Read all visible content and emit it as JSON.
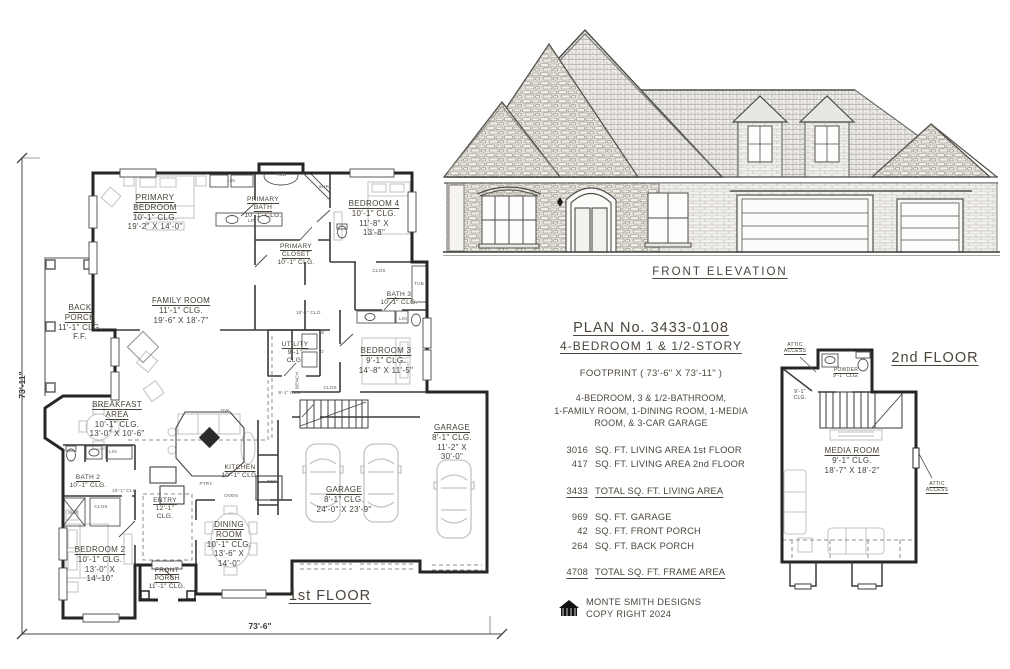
{
  "titles": {
    "front_elevation": "FRONT ELEVATION",
    "first_floor": "1st FLOOR",
    "second_floor": "2nd FLOOR"
  },
  "dimensions": {
    "overall_depth": "73'-11\"",
    "overall_width": "73'-6\""
  },
  "info": {
    "plan_no": "PLAN No. 3433-0108",
    "subtitle": "4-BEDROOM  1 & 1/2-STORY",
    "footprint": "FOOTPRINT ( 73'-6\" X 73'-11\" )",
    "description": [
      "4-BEDROOM, 3 & 1/2-BATHROOM,",
      "1-FAMILY ROOM, 1-DINING ROOM, 1-MEDIA",
      "ROOM, & 3-CAR GARAGE"
    ],
    "areas": [
      {
        "value": "3016",
        "label": "SQ. FT. LIVING AREA 1st FLOOR"
      },
      {
        "value": "417",
        "label": "SQ. FT. LIVING AREA 2nd FLOOR"
      }
    ],
    "total_living": {
      "value": "3433",
      "label": "TOTAL SQ. FT. LIVING AREA"
    },
    "other_areas": [
      {
        "value": "969",
        "label": "SQ. FT. GARAGE"
      },
      {
        "value": "42",
        "label": "SQ. FT. FRONT PORCH"
      },
      {
        "value": "264",
        "label": "SQ. FT. BACK PORCH"
      }
    ],
    "total_frame": {
      "value": "4708",
      "label": "TOTAL SQ. FT. FRAME AREA"
    },
    "credit_line1": "MONTE SMITH DESIGNS",
    "credit_line2": "COPY RIGHT 2024"
  },
  "floor1_rooms": [
    {
      "id": "primary-bedroom",
      "x": 155,
      "y": 193,
      "size": "m",
      "lines": [
        {
          "t": "PRIMARY",
          "u": 1
        },
        {
          "t": "BEDROOM",
          "u": 1
        },
        {
          "t": "10'-1\" CLG."
        },
        {
          "t": "19'-2\" X 14'-0\""
        }
      ]
    },
    {
      "id": "primary-bath",
      "x": 263,
      "y": 196,
      "size": "s",
      "lines": [
        {
          "t": "PRIMARY",
          "u": 1
        },
        {
          "t": "BATH",
          "u": 1
        },
        {
          "t": "10'-1\" CLG."
        }
      ]
    },
    {
      "id": "bedroom-4",
      "x": 374,
      "y": 199,
      "size": "m",
      "lines": [
        {
          "t": "BEDROOM 4",
          "u": 1
        },
        {
          "t": "10'-1\" CLG."
        },
        {
          "t": "11'-8\" X"
        },
        {
          "t": "13'-8\""
        }
      ]
    },
    {
      "id": "primary-closet",
      "x": 296,
      "y": 243,
      "size": "s",
      "lines": [
        {
          "t": "PRIMARY",
          "u": 1
        },
        {
          "t": "CLOSET",
          "u": 1
        },
        {
          "t": "10'-1\" CLG."
        }
      ]
    },
    {
      "id": "bath-3",
      "x": 399,
      "y": 291,
      "size": "s",
      "lines": [
        {
          "t": "BATH 3",
          "u": 1
        },
        {
          "t": "10'-1\" CLG."
        }
      ]
    },
    {
      "id": "back-porch",
      "x": 80,
      "y": 303,
      "size": "m",
      "lines": [
        {
          "t": "BACK",
          "u": 1
        },
        {
          "t": "PORCH",
          "u": 1
        },
        {
          "t": "11'-1\" CLG."
        },
        {
          "t": "F.F."
        }
      ]
    },
    {
      "id": "family-room",
      "x": 181,
      "y": 296,
      "size": "m",
      "lines": [
        {
          "t": "FAMILY ROOM",
          "u": 1
        },
        {
          "t": "11'-1\" CLG."
        },
        {
          "t": "19'-6\" X 18'-7\""
        }
      ]
    },
    {
      "id": "utility",
      "x": 295,
      "y": 341,
      "size": "s",
      "lines": [
        {
          "t": "UTILITY",
          "u": 1
        },
        {
          "t": "9'-1\""
        },
        {
          "t": "CLG."
        }
      ]
    },
    {
      "id": "bedroom-3",
      "x": 386,
      "y": 346,
      "size": "m",
      "lines": [
        {
          "t": "BEDROOM 3",
          "u": 1
        },
        {
          "t": "9'-1\" CLG."
        },
        {
          "t": "14'-8\" X 11'-5\""
        }
      ]
    },
    {
      "id": "breakfast-area",
      "x": 117,
      "y": 400,
      "size": "m",
      "lines": [
        {
          "t": "BREAKFAST",
          "u": 1
        },
        {
          "t": "AREA",
          "u": 1
        },
        {
          "t": "10'-1\" CLG."
        },
        {
          "t": "13'-0\" X 10'-6\""
        }
      ]
    },
    {
      "id": "kitchen",
      "x": 240,
      "y": 464,
      "size": "s",
      "lines": [
        {
          "t": "KITCHEN",
          "u": 1
        },
        {
          "t": "10'-1\" CLG."
        }
      ]
    },
    {
      "id": "bath-2",
      "x": 88,
      "y": 474,
      "size": "s",
      "lines": [
        {
          "t": "BATH 2",
          "u": 1
        },
        {
          "t": "10'-1\" CLG."
        }
      ]
    },
    {
      "id": "entry",
      "x": 165,
      "y": 497,
      "size": "s",
      "lines": [
        {
          "t": "ENTRY",
          "u": 1
        },
        {
          "t": "12'-1\""
        },
        {
          "t": "CLG."
        }
      ]
    },
    {
      "id": "dining-room",
      "x": 229,
      "y": 520,
      "size": "m",
      "lines": [
        {
          "t": "DINING",
          "u": 1
        },
        {
          "t": "ROOM",
          "u": 1
        },
        {
          "t": "10'-1\" CLG."
        },
        {
          "t": "13'-6\" X"
        },
        {
          "t": "14'-0\""
        }
      ]
    },
    {
      "id": "bedroom-2",
      "x": 100,
      "y": 545,
      "size": "m",
      "lines": [
        {
          "t": "BEDROOM 2",
          "u": 1
        },
        {
          "t": "10'-1\" CLG."
        },
        {
          "t": "13'-0\" X"
        },
        {
          "t": "14'-10\""
        }
      ]
    },
    {
      "id": "front-porch",
      "x": 167,
      "y": 567,
      "size": "s",
      "lines": [
        {
          "t": "FRONT",
          "u": 1
        },
        {
          "t": "PORCH",
          "u": 1
        },
        {
          "t": "11'-1\" CLG."
        }
      ]
    },
    {
      "id": "garage-main",
      "x": 344,
      "y": 485,
      "size": "m",
      "lines": [
        {
          "t": "GARAGE",
          "u": 1
        },
        {
          "t": "8'-1\" CLG."
        },
        {
          "t": "24'-0\" X 23'-9\""
        }
      ]
    },
    {
      "id": "garage-single",
      "x": 452,
      "y": 423,
      "size": "m",
      "lines": [
        {
          "t": "GARAGE",
          "u": 1
        },
        {
          "t": "8'-1\" CLG."
        },
        {
          "t": "11'-2\" X"
        },
        {
          "t": "30'-0\""
        }
      ]
    }
  ],
  "floor2_rooms": [
    {
      "id": "media-room",
      "x": 852,
      "y": 446,
      "size": "m",
      "lines": [
        {
          "t": "MEDIA ROOM",
          "u": 1
        },
        {
          "t": "9'-1\" CLG."
        },
        {
          "t": "18'-7\" X 18'-2\""
        }
      ]
    },
    {
      "id": "powder",
      "x": 846,
      "y": 368,
      "size": "t",
      "lines": [
        {
          "t": "POWDER",
          "u": 1
        },
        {
          "t": "9'-1\" CLG."
        }
      ]
    },
    {
      "id": "attic-access-left",
      "x": 795,
      "y": 343,
      "size": "t",
      "lines": [
        {
          "t": "ATTIC",
          "u": 1
        },
        {
          "t": "ACCESS",
          "u": 1
        }
      ]
    },
    {
      "id": "attic-access-right",
      "x": 937,
      "y": 482,
      "size": "t",
      "lines": [
        {
          "t": "ATTIC",
          "u": 1
        },
        {
          "t": "ACCESS",
          "u": 1
        }
      ]
    },
    {
      "id": "ceiling-note-2f",
      "x": 800,
      "y": 390,
      "size": "t",
      "lines": [
        {
          "t": "9'-1\""
        },
        {
          "t": "CLG."
        }
      ]
    }
  ],
  "small_labels": [
    {
      "x": 281,
      "y": 172,
      "t": "TUB"
    },
    {
      "x": 324,
      "y": 184,
      "t": "SHR"
    },
    {
      "x": 231,
      "y": 178,
      "t": "LIN"
    },
    {
      "x": 252,
      "y": 218,
      "t": "LIN"
    },
    {
      "x": 379,
      "y": 268,
      "t": "CLOS"
    },
    {
      "x": 419,
      "y": 281,
      "t": "TUB"
    },
    {
      "x": 403,
      "y": 316,
      "t": "LIN"
    },
    {
      "x": 322,
      "y": 330,
      "t": "W"
    },
    {
      "x": 322,
      "y": 349,
      "t": "D"
    },
    {
      "x": 297,
      "y": 378,
      "t": "BENCH",
      "rot": 1
    },
    {
      "x": 330,
      "y": 385,
      "t": "CLOS"
    },
    {
      "x": 225,
      "y": 408,
      "t": "DW"
    },
    {
      "x": 206,
      "y": 481,
      "t": "PTRY"
    },
    {
      "x": 231,
      "y": 493,
      "t": "OVEN"
    },
    {
      "x": 272,
      "y": 479,
      "t": "REF"
    },
    {
      "x": 309,
      "y": 310,
      "t": "10'-1\" CLG."
    },
    {
      "x": 125,
      "y": 488,
      "t": "10'-1\" CLG."
    },
    {
      "x": 290,
      "y": 390,
      "t": "9'-1\" CLG."
    },
    {
      "x": 113,
      "y": 449,
      "t": "LIN"
    },
    {
      "x": 101,
      "y": 504,
      "t": "CLOS"
    },
    {
      "x": 73,
      "y": 510,
      "t": "SHR"
    }
  ]
}
